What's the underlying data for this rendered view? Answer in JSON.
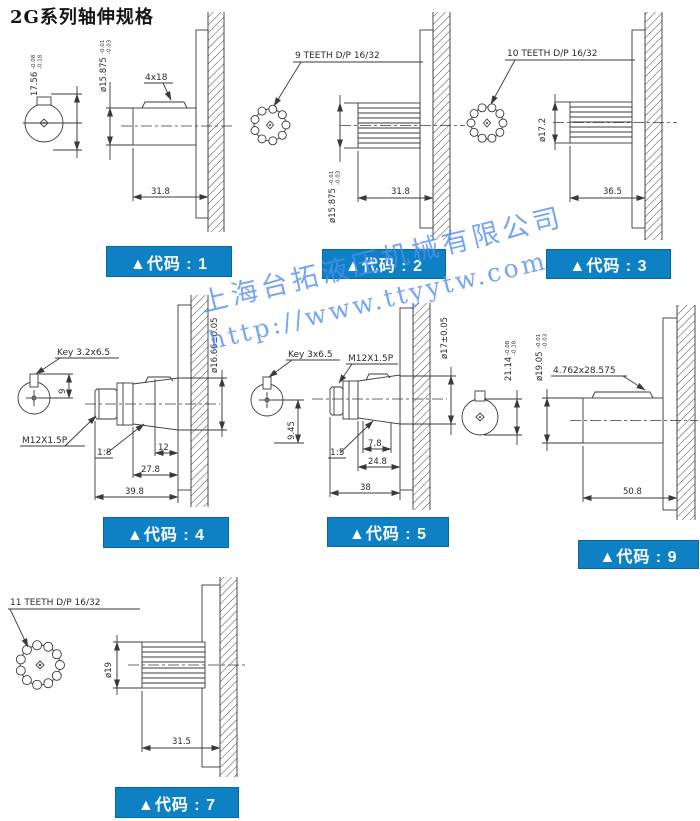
{
  "page": {
    "title": "2G系列轴伸规格"
  },
  "watermark": {
    "line1": "上海台拓液压机械有限公司",
    "line2": "http://www.ttyytw.com"
  },
  "colors": {
    "code_box_bg": "#0e81c4",
    "code_box_border": "#0a66a0",
    "watermark": "#4f8ef0",
    "line": "#3a3a3a"
  },
  "drawings": {
    "d1": {
      "code": "▲代码 : 1",
      "key_label": "4x18",
      "flat_dim": "17.56",
      "flat_tol_up": "-0.08",
      "flat_tol_dn": "-0.18",
      "dia_dim": "ø15.875",
      "dia_tol_up": "-0.01",
      "dia_tol_dn": "-0.03",
      "length_dim": "31.8"
    },
    "d2": {
      "code": "▲代码 : 2",
      "teeth_label": "9 TEETH D/P 16/32",
      "dia_dim": "ø15.875",
      "dia_tol_up": "-0.01",
      "dia_tol_dn": "-0.03",
      "length_dim": "31.8"
    },
    "d3": {
      "code": "▲代码 : 3",
      "teeth_label": "10 TEETH D/P 16/32",
      "dia_dim": "ø17.2",
      "length_dim": "36.5"
    },
    "d4": {
      "code": "▲代码 : 4",
      "key_label": "Key 3.2x6.5",
      "key_offset": "9",
      "thread_label": "M12X1.5P",
      "taper_label": "1:8",
      "dim_a": "12",
      "dim_b": "27.8",
      "dim_c": "39.8",
      "dia_dim": "ø16.66±0.05"
    },
    "d5": {
      "code": "▲代码 : 5",
      "key_label": "Key 3x6.5",
      "key_offset": "9.45",
      "thread_label": "M12X1.5P",
      "taper_label": "1:5",
      "dim_a": "7.8",
      "dim_b": "24.8",
      "dim_c": "38",
      "dia_dim": "ø17±0.05"
    },
    "d9": {
      "code": "▲代码 : 9",
      "key_label": "4.762x28.575",
      "flat_dim": "21.14",
      "flat_tol_up": "-0.08",
      "flat_tol_dn": "-0.18",
      "dia_dim": "ø19.05",
      "dia_tol_up": "-0.01",
      "dia_tol_dn": "-0.03",
      "length_dim": "50.8"
    },
    "d7": {
      "code": "▲代码 : 7",
      "teeth_label": "11 TEETH D/P 16/32",
      "dia_dim": "ø19",
      "length_dim": "31.5"
    }
  }
}
